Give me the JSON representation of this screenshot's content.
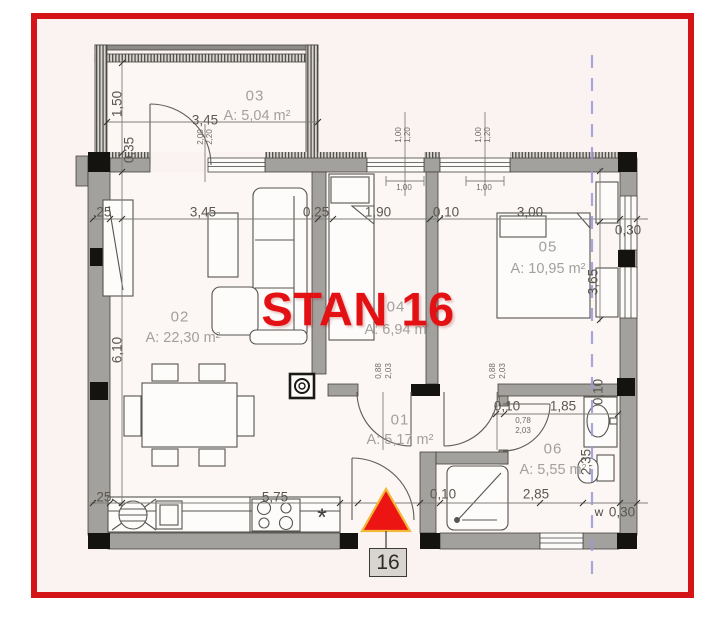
{
  "title": {
    "stan": "STAN 16",
    "unit": "16"
  },
  "watermark": "Dogma",
  "rooms": [
    {
      "id": "03",
      "area": "A: 5,04 m²"
    },
    {
      "id": "02",
      "area": "A: 22,30 m²"
    },
    {
      "id": "04",
      "area": "A: 6,94 m²"
    },
    {
      "id": "05",
      "area": "A: 10,95 m²"
    },
    {
      "id": "01",
      "area": "A: 5,17 m²"
    },
    {
      "id": "06",
      "area": "A: 5,55 m²"
    }
  ],
  "dims": {
    "balcony_depth": "1,50",
    "wall_top": "0,35",
    "balcony_width": "3,45",
    "left_offset": ",25",
    "living_width": "3,45",
    "wall_mid": "0,25",
    "room04_width": "1,90",
    "wall_thin": "0,10",
    "room05_width": "3,00",
    "wall_right": "0,30",
    "living_height": "6,10",
    "room05_height": "3,65",
    "bath_height": "2,35",
    "bath_wall": "0,10",
    "bath_width": "1,85",
    "bath_door_w": "0,78",
    "bath_door_h": "2,03",
    "bottom_offset": ",25",
    "kitchen_width": "5,75",
    "entry_wall": "0,10",
    "bath_bottom_width": "2,85",
    "window_mark": "w",
    "bottom_wall": "0,30",
    "kitchen_symbol": "*",
    "door_w": "0,88",
    "door_h": "2,03",
    "balcony_door_w": "2,00",
    "balcony_door_h": "2,20",
    "window_w": "1,00",
    "window_h": "1,20",
    "window_sill": "1,00"
  }
}
